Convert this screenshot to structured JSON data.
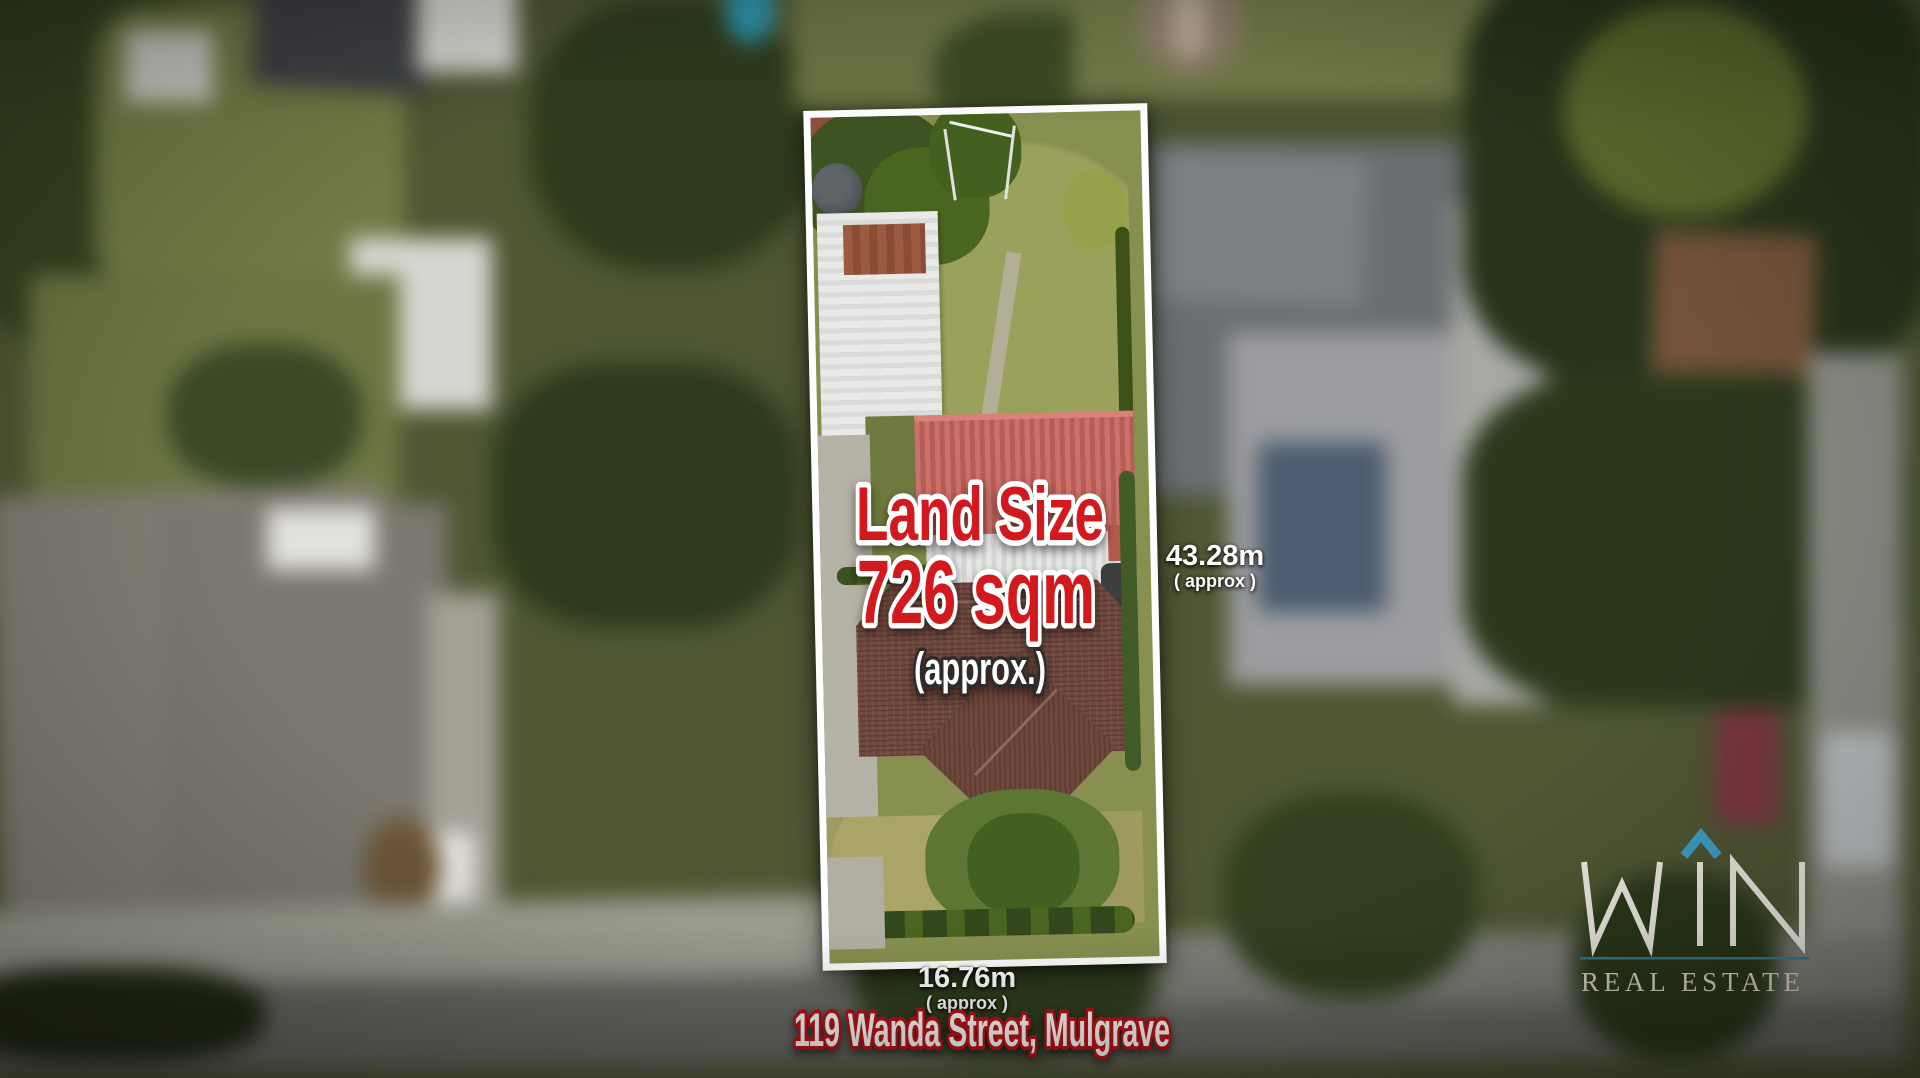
{
  "property_card": {
    "land_size": {
      "label": "Land Size",
      "value": "726 sqm",
      "qualifier": "(approx.)"
    },
    "dimensions": {
      "side": {
        "value": "43.28m",
        "qualifier": "( approx )"
      },
      "frontage": {
        "value": "16.76m",
        "qualifier": "( approx )"
      }
    },
    "address": "119 Wanda Street, Mulgrave"
  },
  "branding": {
    "brand": "WIN",
    "tagline": "REAL ESTATE",
    "roof_icon": "caret-roof",
    "accent_color": "#3f9fca",
    "divider_color": "#2f7e99",
    "text_color": "#ddd8c6"
  },
  "colors": {
    "highlight_red": "#d2191e",
    "outline_white": "#ffffff",
    "address_fill": "#fffdf6",
    "address_outline_red": "#b8131a",
    "dimension_text": "#ffffff",
    "boundary_border": "#ffffff"
  }
}
